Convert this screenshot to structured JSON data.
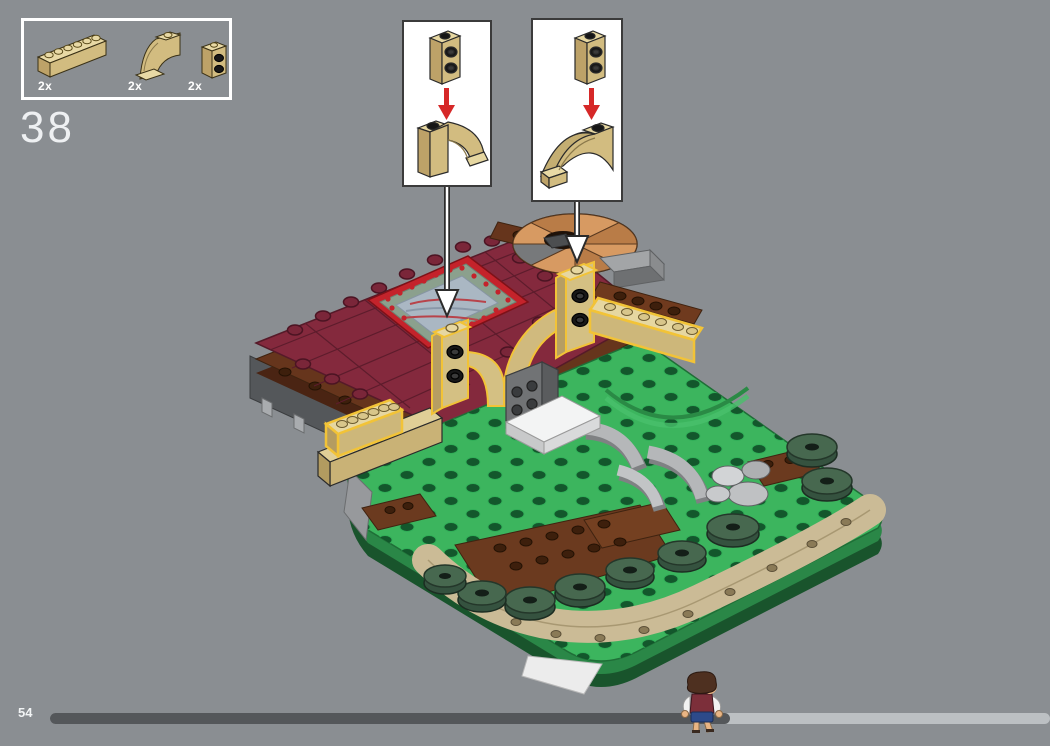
{
  "app": {
    "type": "lego-building-instructions-viewer",
    "background_color": "#8a8e92"
  },
  "step_panel": {
    "step_number": "38"
  },
  "parts_panel": {
    "parts": [
      {
        "name": "brick-1x6-tan",
        "count_label": "2x"
      },
      {
        "name": "inverted-arch-brick-tan",
        "count_label": "2x"
      },
      {
        "name": "brick-1x1-with-side-studs-tan",
        "count_label": "2x"
      }
    ]
  },
  "callouts": [
    {
      "name": "callout-left",
      "parts": [
        "brick-1x1-with-side-studs-tan",
        "inverted-arch-brick-tan-right-facing"
      ],
      "arrow_color": "#d62828"
    },
    {
      "name": "callout-right",
      "parts": [
        "brick-1x1-with-side-studs-tan",
        "inverted-arch-brick-tan-left-facing"
      ],
      "arrow_color": "#d62828"
    }
  ],
  "model": {
    "description": "isometric LEGO diorama: dark-red tiled roof with ornate rug tile, spiral staircase, tan wall with two arch columns (new pieces highlighted yellow), green studded base with trees, tan paths, gray rocks and curved walls",
    "highlight_color": "#f2c337"
  },
  "footer": {
    "page_number": "54",
    "progress_percent": 68
  },
  "colors": {
    "background": "#8a8e92",
    "roof_maroon": "#84293d",
    "brick_tan": "#e0cf97",
    "base_green": "#3cb55e",
    "tree_green": "#47684f",
    "earth_brown": "#66351c",
    "arrow_red": "#d62828",
    "highlight_yellow": "#f2c337",
    "progress_fill": "#54575a",
    "progress_track": "#bcc0c3"
  }
}
